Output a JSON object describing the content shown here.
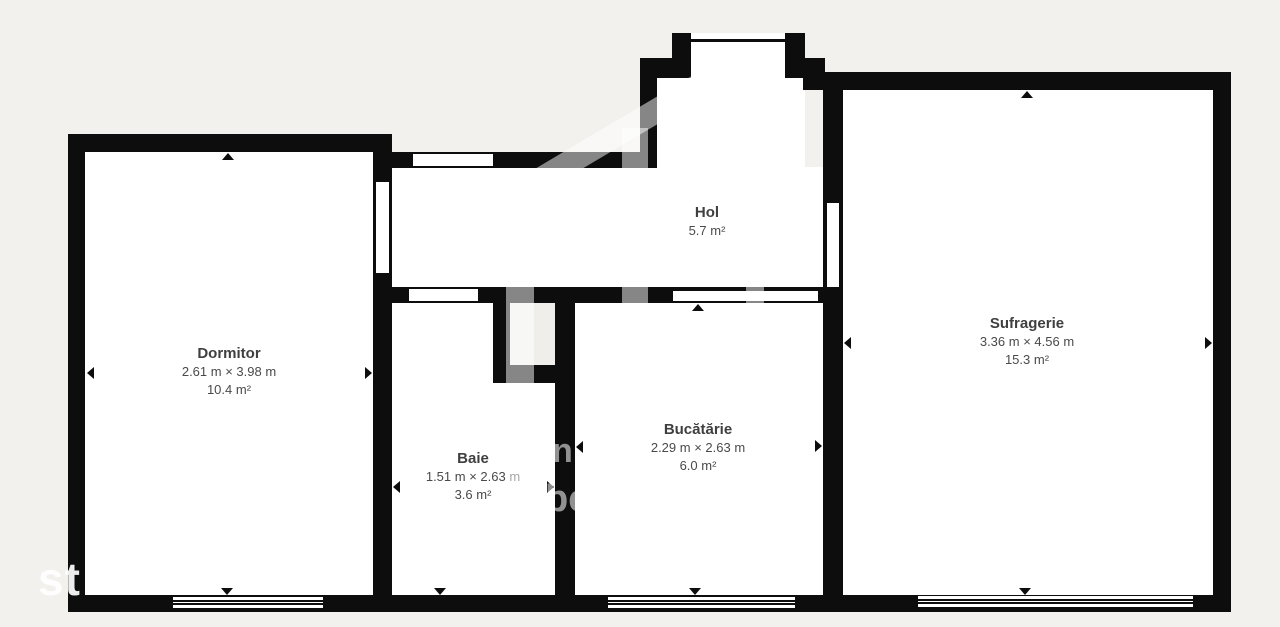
{
  "plan": {
    "background_color": "#f2f1ee",
    "wall_color": "#0d0d0d",
    "room_fill": "#ffffff",
    "text_color": "#3f3f3f"
  },
  "rooms": [
    {
      "id": "dormitor",
      "name": "Dormitor",
      "dimensions": "2.61 m × 3.98 m",
      "area": "10.4 m²"
    },
    {
      "id": "hol",
      "name": "Hol",
      "dimensions": "",
      "area": "5.7 m²"
    },
    {
      "id": "baie",
      "name": "Baie",
      "dimensions": "1.51 m × 2.63 m",
      "area": "3.6 m²"
    },
    {
      "id": "bucatarie",
      "name": "Bucătărie",
      "dimensions": "2.29 m × 2.63 m",
      "area": "6.0 m²"
    },
    {
      "id": "sufragerie",
      "name": "Sufragerie",
      "dimensions": "3.36 m × 4.56 m",
      "area": "15.3 m²"
    }
  ],
  "watermark": {
    "corner_text": "st",
    "wall_fragments": [
      "n",
      "be"
    ]
  }
}
